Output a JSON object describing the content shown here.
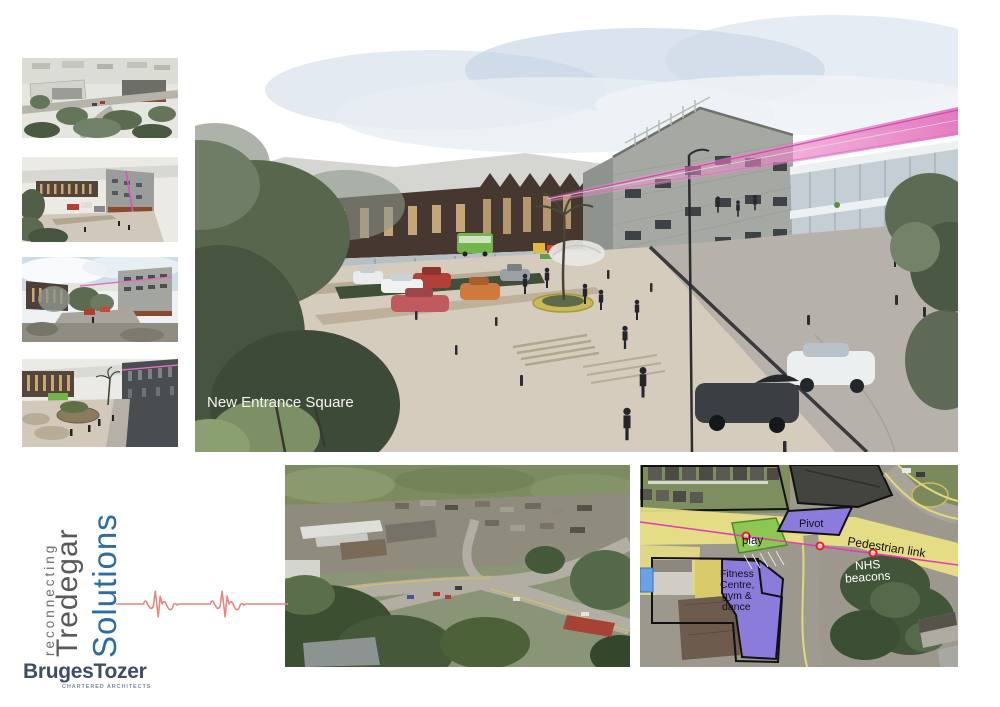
{
  "branding": {
    "tagline": {
      "line1": "reconnecting",
      "line2": "Tredegar",
      "line3": "Solutions"
    },
    "firm": {
      "name": "BrugesTozer",
      "subtitle": "CHARTERED ARCHITECTS"
    },
    "colors": {
      "gray_text": "#6d6e71",
      "dark_gray_text": "#58595b",
      "blue_text": "#2d6da3",
      "navy": "#3d4e6b",
      "ecg_red": "#e8857d"
    }
  },
  "main_render": {
    "caption": "New Entrance Square"
  },
  "site_plan": {
    "labels": {
      "pivot": "Pivot",
      "play": "play",
      "pedestrian_link": "Pedestrian link",
      "nhs_line1": "NHS",
      "nhs_line2": "beacons",
      "fitness_line1": "Fitness",
      "fitness_line2": "Centre,",
      "fitness_line3": "gym &",
      "fitness_line4": "dance"
    },
    "colors": {
      "highlight_yellow": "#ece285",
      "building_purple": "#8b7cdb",
      "link_magenta": "#e53ab5",
      "node_red": "#dc2626",
      "play_green": "#8cc653"
    }
  }
}
